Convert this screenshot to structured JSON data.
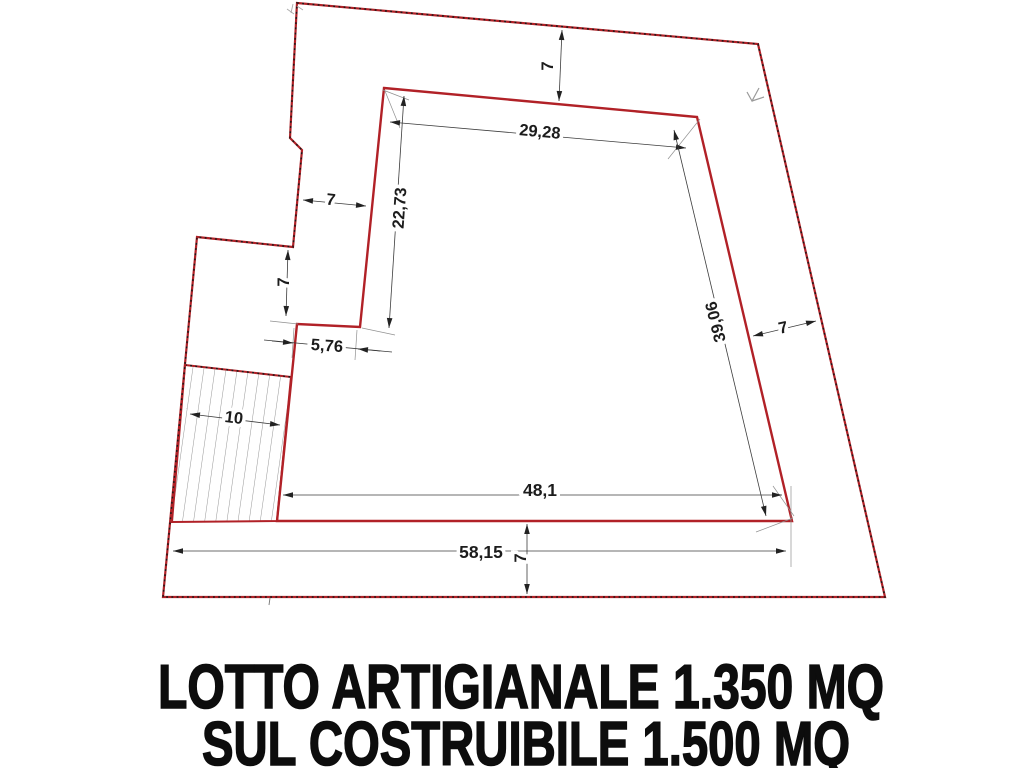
{
  "plan": {
    "dimensions": {
      "top_setback": "7",
      "top_width": "29,28",
      "upper_left_height": "22,73",
      "left_setback": "7",
      "left_step_height": "7",
      "left_jog_width": "5,76",
      "access_strip_width": "10",
      "right_side_length": "39,06",
      "right_setback": "7",
      "bottom_inner_width": "48,1",
      "bottom_outer_width": "58,15",
      "bottom_setback": "7"
    },
    "colors": {
      "boundary_red": "#b12127",
      "dimension_line": "#3c3c3c",
      "extension_line": "#909090",
      "hatch_line": "#8a8a8a",
      "label_text": "#1c1c1c",
      "caption_text": "#0d0d0d"
    }
  },
  "caption": {
    "line1": "LOTTO ARTIGIANALE 1.350 MQ",
    "line2": "SUL COSTRUIBILE 1.500 MQ"
  }
}
